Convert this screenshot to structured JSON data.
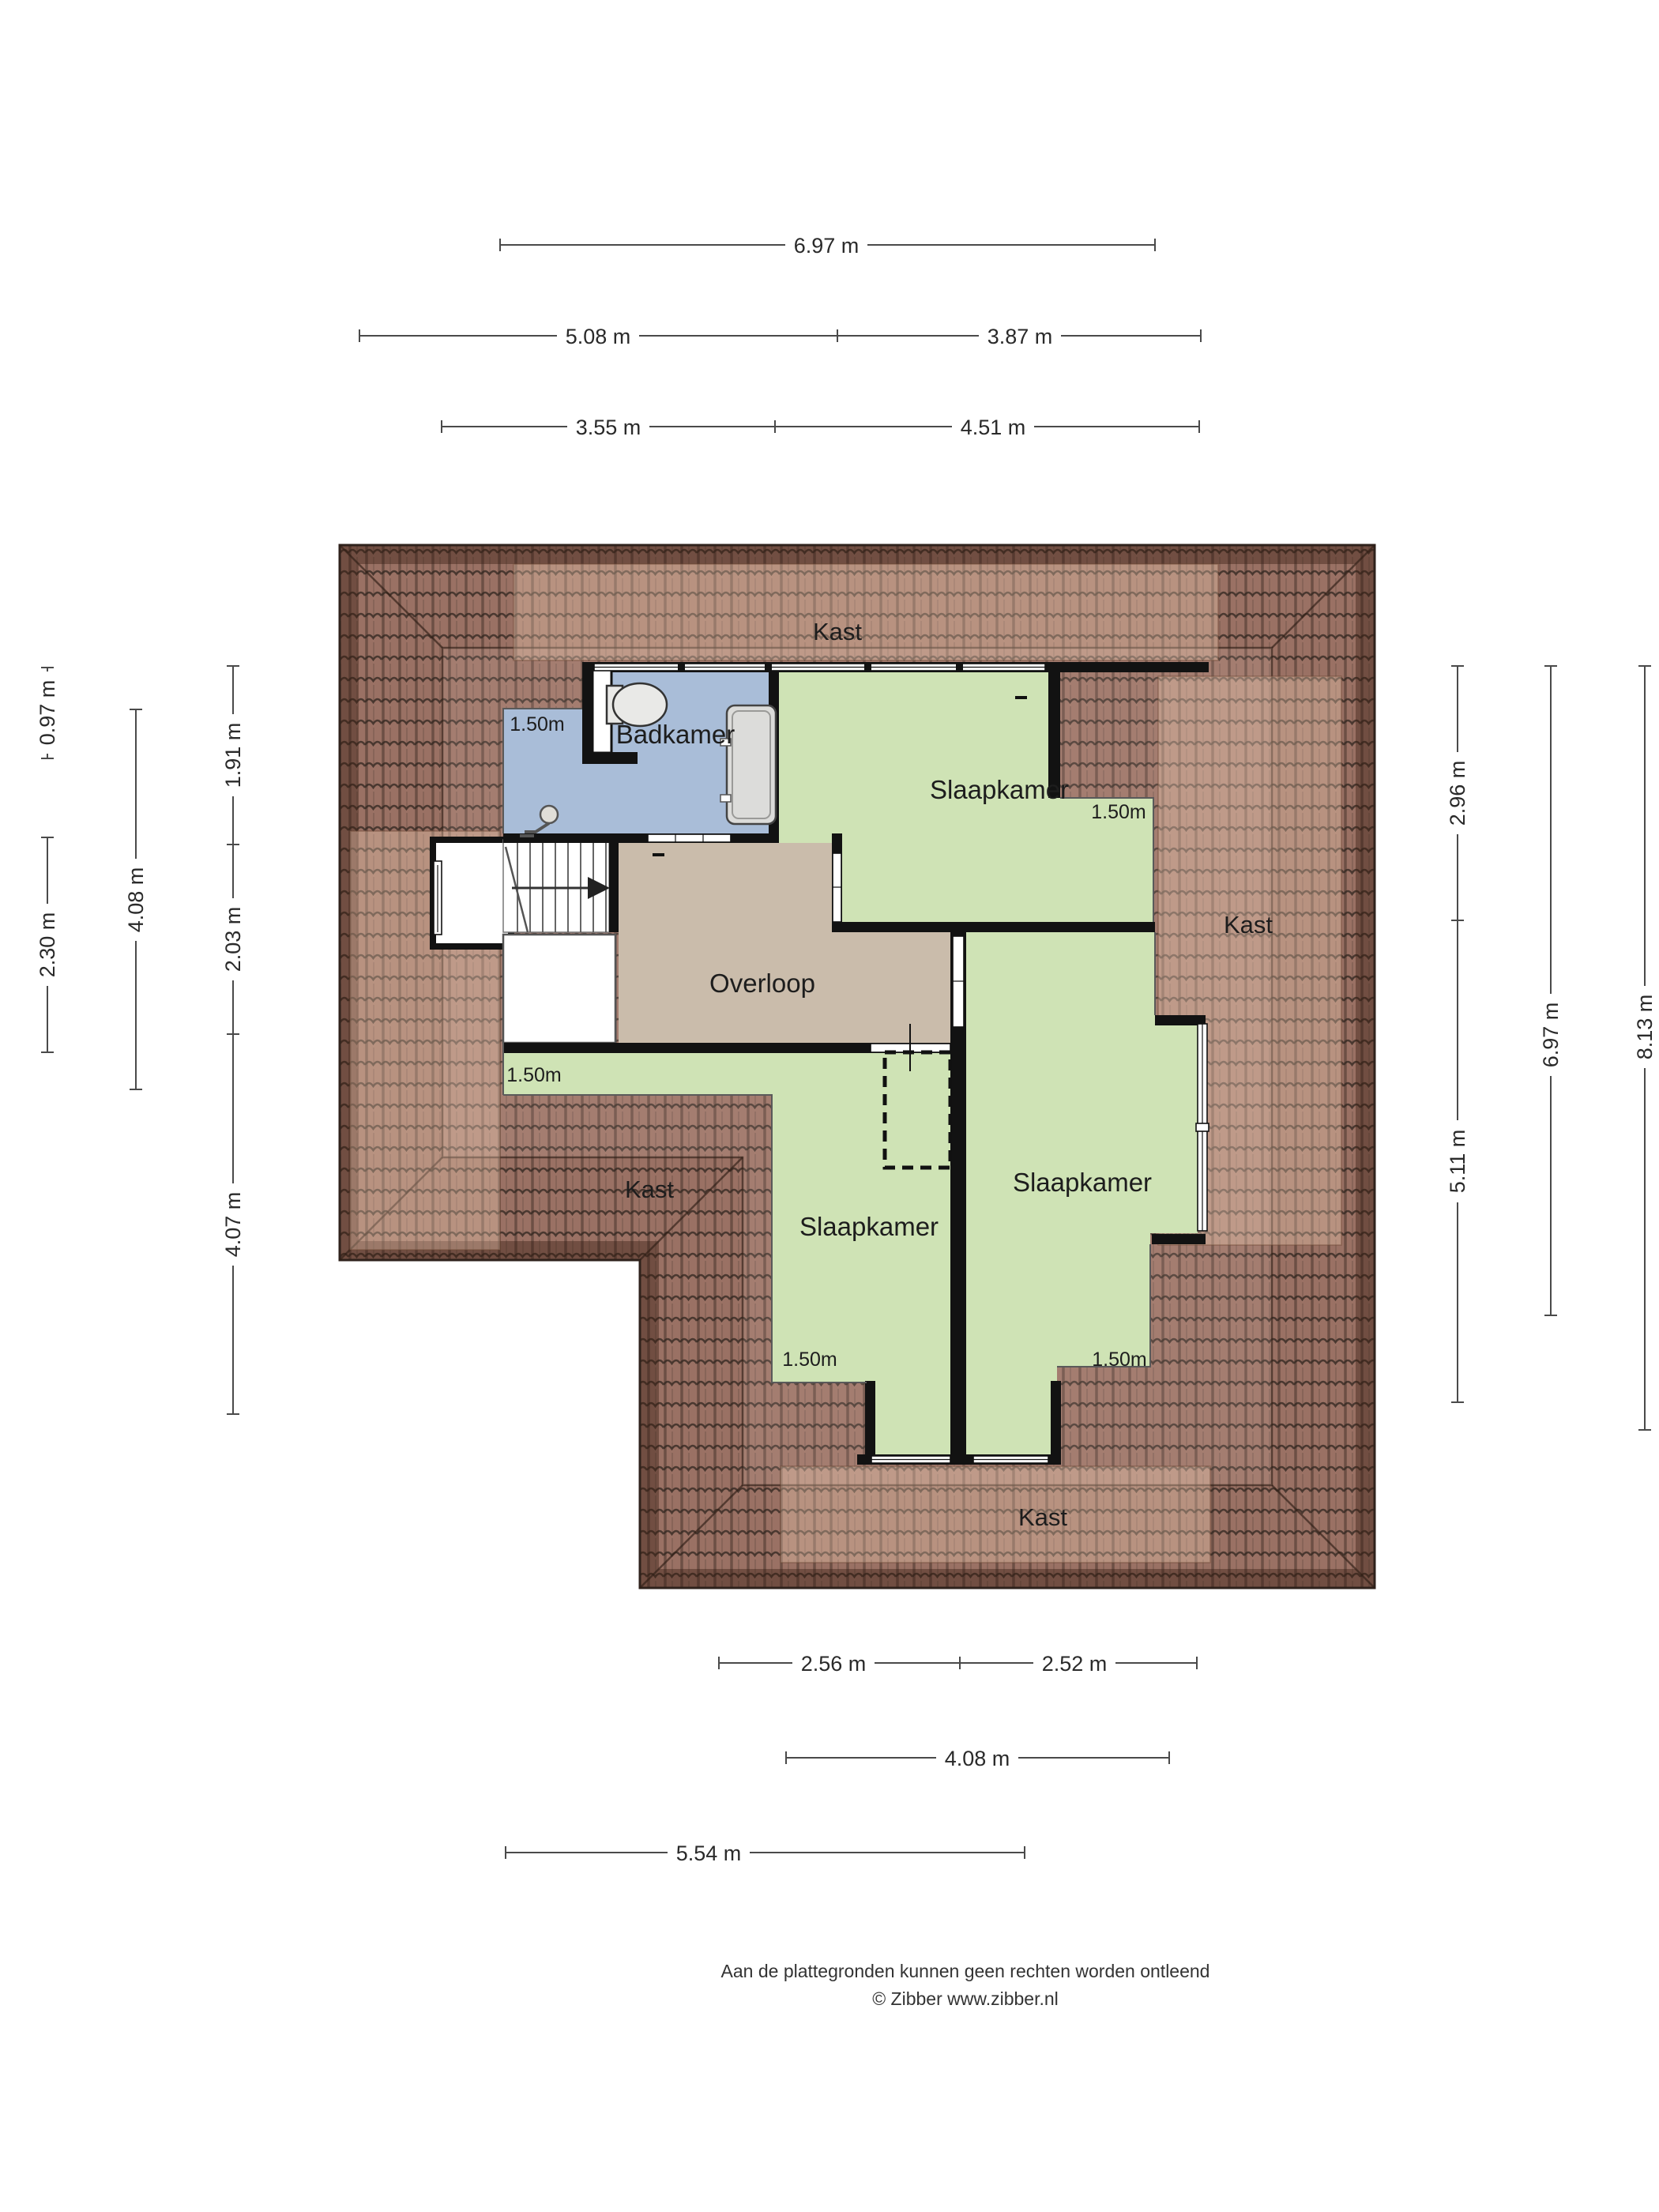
{
  "footer": {
    "line1": "Aan de plattegronden kunnen geen rechten worden ontleend",
    "line2": "© Zibber www.zibber.nl"
  },
  "rooms": {
    "badkamer": "Badkamer",
    "slaapkamer_top": "Slaapkamer",
    "slaapkamer_left": "Slaapkamer",
    "slaapkamer_right": "Slaapkamer",
    "overloop": "Overloop"
  },
  "closets": {
    "top": "Kast",
    "right": "Kast",
    "left": "Kast",
    "bottom": "Kast"
  },
  "knee_labels": {
    "badkamer": "1.50m",
    "slaapkamer_top": "1.50m",
    "left_mid": "1.50m",
    "slaapkamer_left": "1.50m",
    "slaapkamer_right": "1.50m"
  },
  "dimensions": {
    "h": [
      {
        "label": "6.97 m"
      },
      {
        "label": "5.08 m"
      },
      {
        "label": "3.87 m"
      },
      {
        "label": "3.55 m"
      },
      {
        "label": "4.51 m"
      },
      {
        "label": "2.56 m"
      },
      {
        "label": "2.52 m"
      },
      {
        "label": "4.08 m"
      },
      {
        "label": "5.54 m"
      }
    ],
    "v": [
      {
        "label": "0.97 m"
      },
      {
        "label": "2.30 m"
      },
      {
        "label": "4.08 m"
      },
      {
        "label": "1.91 m"
      },
      {
        "label": "2.03 m"
      },
      {
        "label": "4.07 m"
      },
      {
        "label": "2.96 m"
      },
      {
        "label": "5.11 m"
      },
      {
        "label": "6.97 m"
      },
      {
        "label": "8.13 m"
      }
    ]
  },
  "colors": {
    "bedroom": "#cfe3b5",
    "bathroom": "#a9bdd8",
    "landing": "#cabcab",
    "roof_base": "#9a7164",
    "roof_band": "rgba(58,32,20,0.42)",
    "wash": "rgba(255,222,196,0.30)",
    "wall": "#121212",
    "fixture": "#e9e9e7"
  }
}
